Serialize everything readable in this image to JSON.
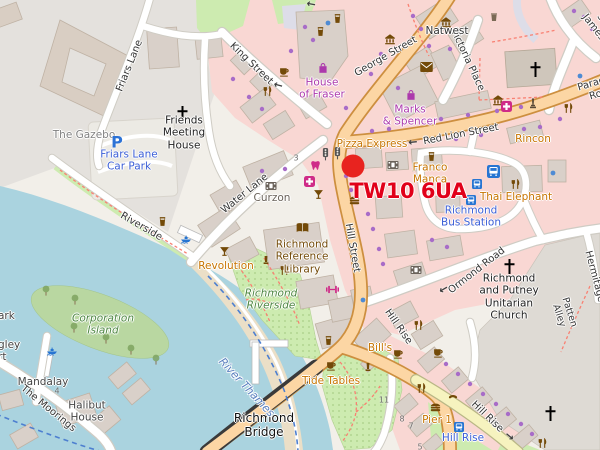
{
  "map": {
    "marker": {
      "postcode": "TW10 6UA"
    },
    "roads": {
      "friars_lane": "Friars Lane",
      "king_street": "King Street",
      "george_street": "George Street",
      "victoria_place": "Victoria Place",
      "st_james": "St. James",
      "red_lion_street": "Red Lion Street",
      "paradise_road": "Paradise Road",
      "water_lane": "Water Lane",
      "riverside": "Riverside",
      "hill_street": "Hill Street",
      "ormond_road": "Ormond Road",
      "the_hermitage": "The Hermitage",
      "patten_alley": "Patten Alley",
      "hill_rise_upper": "Hill Rise",
      "hill_rise_road": "Hill Rise",
      "the_moorings": "The Moorings",
      "richmond_bridge": "Richmond\nBridge"
    },
    "places": {
      "the_gazebo": "The Gazebo",
      "friends_meeting_house": "Friends\nMeeting\nHouse",
      "parking_symbol": "P",
      "friars_lane_car_park": "Friars Lane\nCar Park",
      "house_of_fraser": "House\nof Fraser",
      "natwest": "Natwest",
      "marks_and_spencer": "Marks\n& Spencer",
      "pizza_express": "Pizza Express",
      "rincon": "Rincon",
      "franco_manca": "Franco\nManca",
      "thai_elephant": "Thai Elephant",
      "richmond_bus_station": "Richmond\nBus Station",
      "unitarian_church": "Richmond\nand Putney\nUnitarian\nChurch",
      "curzon": "Curzon",
      "revolution": "Revolution",
      "library": "Richmond\nReference\nLibrary",
      "richmond_riverside": "Richmond\nRiverside",
      "bills": "Bill's",
      "tide_tables": "Tide Tables",
      "pier_1": "Pier 1",
      "hill_rise_stop": "Hill Rise",
      "river_thames": "River Thames",
      "corporation_island": "Corporation\nIsland",
      "mandalay": "Mandalay",
      "halibut_house": "Halibut\nHouse",
      "fragment_ark": "ark",
      "fragment_gley": "gley",
      "fragment_rt": "rt"
    },
    "numbers": {
      "n3": "3",
      "n4": "4",
      "n5": "5",
      "n7": "7",
      "n8": "8",
      "n11": "11"
    },
    "glyphs": {
      "arrow_left": "←",
      "arrow_right": "→"
    },
    "colors": {
      "marker_red": "#e8231f",
      "postcode_red": "#e10019",
      "water": "#aad3df",
      "primary_road": "#fcd6a4",
      "garden_green": "#cdebb0",
      "retail_pink": "#f9d7d3",
      "transit_blue": "#2b72d6",
      "shop_purple": "#ac39ac",
      "amenity_brown": "#734a08",
      "gastro_orange": "#c77400",
      "health_magenta": "#cf2b88",
      "poi_dot_purple": "#a86cc8"
    }
  }
}
